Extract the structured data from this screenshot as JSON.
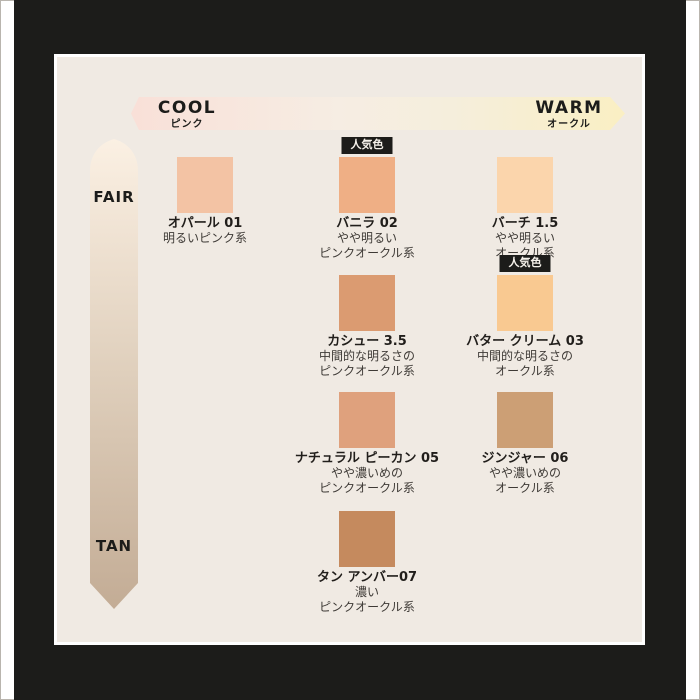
{
  "axes": {
    "cool_label": "COOL",
    "cool_sub": "ピンク",
    "warm_label": "WARM",
    "warm_sub": "オークル",
    "fair_label": "FAIR",
    "tan_label": "TAN"
  },
  "badge_label": "人気色",
  "colors": {
    "mat_black": "#1C1C1A",
    "panel_bg": "#F0EAE3",
    "arrow_pink": "#F9E0D8",
    "arrow_yellow": "#FAEFC3",
    "band_top": "#FBF0E3",
    "band_bottom": "#C3AC95",
    "badge_bg": "#1C1C1A",
    "badge_text": "#F5F1EA"
  },
  "shades": [
    {
      "name": "オパール 01",
      "desc": [
        "明るいピンク系"
      ],
      "color": "#F3C3A4",
      "col": 0,
      "row": 0,
      "popular": false
    },
    {
      "name": "バニラ 02",
      "desc": [
        "やや明るい",
        "ピンクオークル系"
      ],
      "color": "#EFAF85",
      "col": 1,
      "row": 0,
      "popular": true
    },
    {
      "name": "バーチ 1.5",
      "desc": [
        "やや明るい",
        "オークル系"
      ],
      "color": "#FBD5AC",
      "col": 2,
      "row": 0,
      "popular": false
    },
    {
      "name": "カシュー 3.5",
      "desc": [
        "中間的な明るさの",
        "ピンクオークル系"
      ],
      "color": "#DB9B71",
      "col": 1,
      "row": 1,
      "popular": false
    },
    {
      "name": "バター クリーム 03",
      "desc": [
        "中間的な明るさの",
        "オークル系"
      ],
      "color": "#F9C991",
      "col": 2,
      "row": 1,
      "popular": true
    },
    {
      "name": "ナチュラル ピーカン 05",
      "desc": [
        "やや濃いめの",
        "ピンクオークル系"
      ],
      "color": "#DFA17D",
      "col": 1,
      "row": 2,
      "popular": false
    },
    {
      "name": "ジンジャー 06",
      "desc": [
        "やや濃いめの",
        "オークル系"
      ],
      "color": "#CC9F75",
      "col": 2,
      "row": 2,
      "popular": false
    },
    {
      "name": "タン アンバー07",
      "desc": [
        "濃い",
        "ピンクオークル系"
      ],
      "color": "#C58A5E",
      "col": 1,
      "row": 3,
      "popular": false
    }
  ]
}
